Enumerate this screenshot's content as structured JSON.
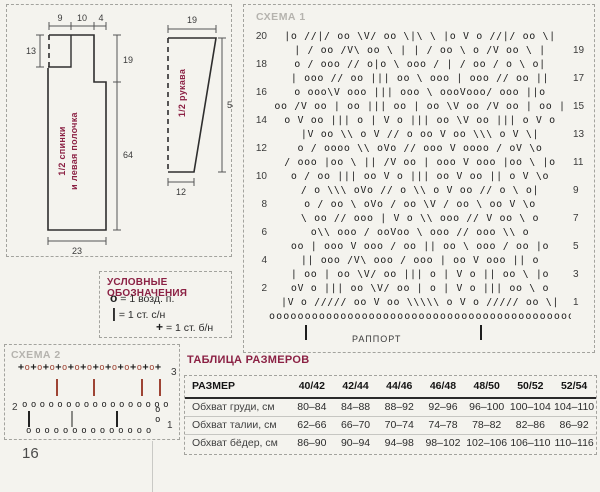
{
  "page": {
    "background": "#f4f3ee",
    "accent": "#8b2144",
    "page_number": "16"
  },
  "schematics": {
    "body_piece": {
      "label_line1": "1/2 спинки",
      "label_line2": "и левая полочка",
      "top_width_1": "9",
      "top_width_2": "10",
      "top_width_3": "4",
      "neck_depth": "13",
      "armhole_height": "19",
      "side_height": "64",
      "bottom_width": "23"
    },
    "sleeve_piece": {
      "label": "1/2 рукава",
      "top_width": "19",
      "height": "54",
      "bottom_width": "12"
    }
  },
  "chart1": {
    "title": "СХЕМА 1",
    "repeat_label": "РАППОРТ",
    "rows": [
      {
        "l": "20",
        "s": "|о //|/ оо \\V/ оо \\|\\ \\ |о V о //|/ оо \\|",
        "r": ""
      },
      {
        "l": "",
        "s": "| / оо /V\\ оо \\ | | / оо \\ о /V оо \\ |",
        "r": "19"
      },
      {
        "l": "18",
        "s": "о / ооо // о|о \\ ооо / | / оо / о \\ о|",
        "r": ""
      },
      {
        "l": "",
        "s": "| ооо // оо ||| оо \\ ооо | ооо // оо ||",
        "r": "17"
      },
      {
        "l": "16",
        "s": "о ооо\\V ооо ||| ооо \\ оооVооо/ ооо ||о",
        "r": ""
      },
      {
        "l": "",
        "s": "оо /V оо | оо ||| оо | оо \\V оо /V оо | оо |",
        "r": "15"
      },
      {
        "l": "14",
        "s": "о V оо ||| о | V о ||| оо \\V оо ||| о V о",
        "r": ""
      },
      {
        "l": "",
        "s": "|V оо \\\\ о V // о оо V оо \\\\\\ о V \\|",
        "r": "13"
      },
      {
        "l": "12",
        "s": "о / оооо \\\\ оVо // ооо V оооо / оV \\о",
        "r": ""
      },
      {
        "l": "",
        "s": "/ ооо |оо \\ || /V оо | ооо V ооо |оо \\ |о",
        "r": "11"
      },
      {
        "l": "10",
        "s": "о / оо ||| оо V о ||| оо V оо || о V \\о",
        "r": ""
      },
      {
        "l": "",
        "s": "/ о \\\\\\ оVо // о \\\\ о V оо // о \\ о|",
        "r": "9"
      },
      {
        "l": "8",
        "s": "о / оо \\ оVо / оо \\V / оо \\ оо V \\о",
        "r": ""
      },
      {
        "l": "",
        "s": "\\ оо // ооо | V о \\\\ ооо // V оо \\ о",
        "r": "7"
      },
      {
        "l": "6",
        "s": "о\\\\ ооо / ооVоо \\ ооо // ооо \\\\ о",
        "r": ""
      },
      {
        "l": "",
        "s": "оо | ооо V ооо / оо || оо \\ ооо / оо |о",
        "r": "5"
      },
      {
        "l": "4",
        "s": "|| ооо /V\\ ооо / ооо | оо V ооо || о",
        "r": ""
      },
      {
        "l": "",
        "s": "| оо | оо \\V/ оо ||| о | V о || оо \\ |о",
        "r": "3"
      },
      {
        "l": "2",
        "s": "оV о ||| оо \\V/ оо | о | V о ||| оо \\ о",
        "r": ""
      },
      {
        "l": "",
        "s": "|V о ///// оо V оо \\\\\\\\\\ о V о ///// оо \\|",
        "r": "1"
      }
    ],
    "foundation": "оооооооооооооооооооооооооооооооооооооооооооо"
  },
  "legend": {
    "title": "УСЛОВНЫЕ ОБОЗНАЧЕНИЯ",
    "items": [
      {
        "symbol": "о",
        "text": "= 1 возд. п."
      },
      {
        "symbol": "|",
        "text": "= 1 ст. с/н"
      },
      {
        "symbol": "+",
        "text": "= 1 ст. б/н"
      }
    ]
  },
  "chart2": {
    "title": "СХЕМА 2",
    "red_color": "#9e4434",
    "row3": {
      "symbols": "+о+о+о+о+о+о+о+о+о+о+о+",
      "number": "3"
    },
    "row2": {
      "number": "2",
      "symbols": "ооооооооооооооооо"
    },
    "row1": {
      "symbols": "оооооооооооооо",
      "number": "1"
    },
    "red_bars_x": [
      51,
      88,
      136,
      154
    ],
    "gray_bars_x": [
      23,
      66,
      111
    ],
    "edge_circles": "оо"
  },
  "size_table": {
    "title": "ТАБЛИЦА РАЗМЕРОВ",
    "header": [
      "РАЗМЕР",
      "40/42",
      "42/44",
      "44/46",
      "46/48",
      "48/50",
      "50/52",
      "52/54"
    ],
    "rows": [
      [
        "Обхват груди, см",
        "80–84",
        "84–88",
        "88–92",
        "92–96",
        "96–100",
        "100–104",
        "104–110"
      ],
      [
        "Обхват талии, см",
        "62–66",
        "66–70",
        "70–74",
        "74–78",
        "78–82",
        "82–86",
        "86–92"
      ],
      [
        "Обхват бёдер, см",
        "86–90",
        "90–94",
        "94–98",
        "98–102",
        "102–106",
        "106–110",
        "110–116"
      ]
    ]
  }
}
